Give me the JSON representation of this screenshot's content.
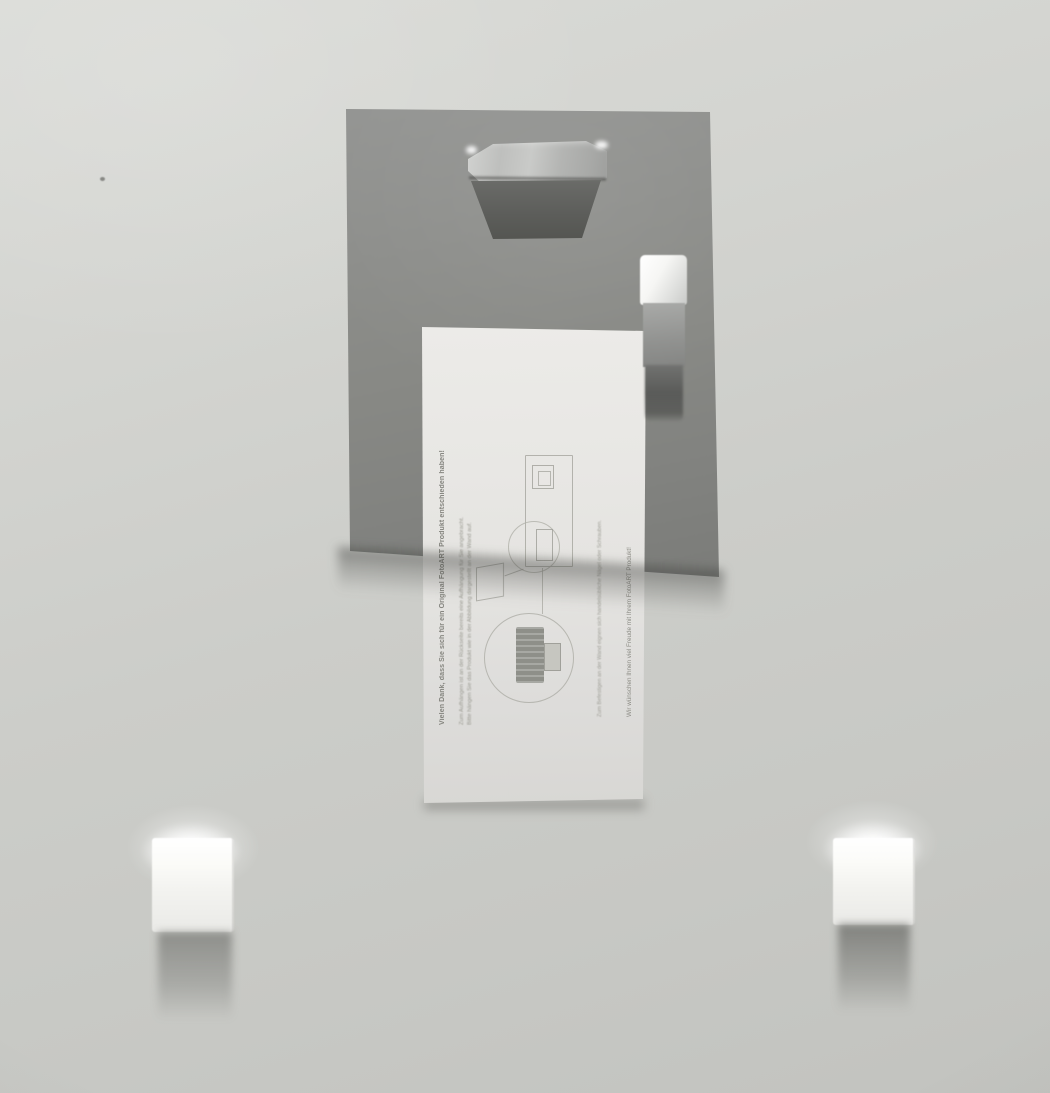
{
  "scene": {
    "description": "Photo of the back of a framed picture: grey hanger plate with punched-out mounting tab, metal clip holding a German instruction card, and two white foam spacer blocks on a light grey wall",
    "colors": {
      "wall": "#cdcec9",
      "plate": "#8a8b87",
      "plate_shadow": "#3e3f3c",
      "card": "#e7e6e3",
      "card_text": "#8c8c85",
      "foam": "#f7f7f4",
      "clip_highlight": "#f6f6f4",
      "hanger_recess": "#5d5e5b"
    }
  },
  "card": {
    "headline": "Vielen Dank, dass Sie sich für ein Original FotoART Produkt entschieden haben!",
    "body_line1": "Zum Aufhängen ist an der Rückseite bereits eine Aufhängung für Sie angebracht.",
    "body_line2": "Bitte hängen Sie das Produkt wie in der Abbildung dargestellt an der Wand auf.",
    "note": "Zum Befestigen an der Wand eignen sich handelsübliche Nägel oder Schrauben.",
    "closing": "Wir wünschen Ihnen viel Freude mit Ihrem FotoART Produkt!"
  }
}
